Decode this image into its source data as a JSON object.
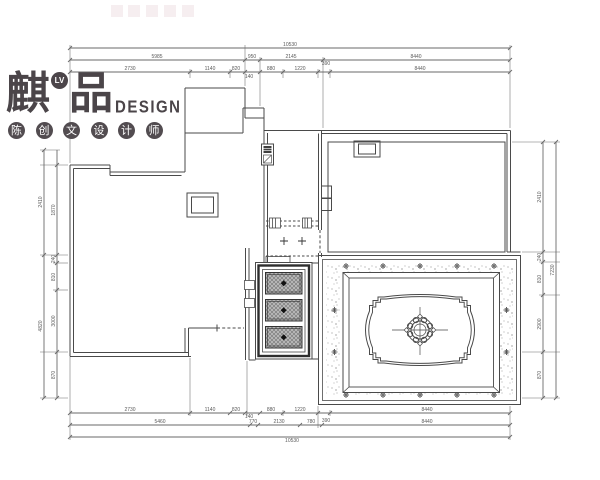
{
  "logo": {
    "brand_left": "麒",
    "brand_right": "品",
    "badge": "LV",
    "brand_en": "DESIGN",
    "designers": [
      "陈",
      "创",
      "文",
      "设",
      "计",
      "师"
    ]
  },
  "dimensions": {
    "top": {
      "total": "10530",
      "row2": [
        "5985",
        "950",
        "2145",
        "8440"
      ],
      "row3": [
        "2730",
        "1140",
        "820",
        "880",
        "1220",
        "8440"
      ],
      "small": [
        "140",
        "390"
      ]
    },
    "bottom": {
      "row1": [
        "2730",
        "1140",
        "820",
        "880",
        "1220",
        "8440"
      ],
      "small": [
        "140",
        "390"
      ],
      "row2": [
        "5460",
        "770",
        "2130",
        "780",
        "8440"
      ],
      "total": "10530"
    },
    "left": {
      "outer": [
        "2410",
        "4820"
      ],
      "inner": [
        "1870",
        "240",
        "810",
        "3000",
        "870"
      ]
    },
    "right": {
      "inner": [
        "2410",
        "240",
        "810",
        "2900",
        "870"
      ],
      "outer": [
        "7230"
      ]
    }
  },
  "colors": {
    "line": "#4a4a4a",
    "dim_text": "#5a5a5a",
    "logo": "#4b4549",
    "hatch_fill": "#b5b5b5",
    "watermark": "#f6eef0"
  }
}
